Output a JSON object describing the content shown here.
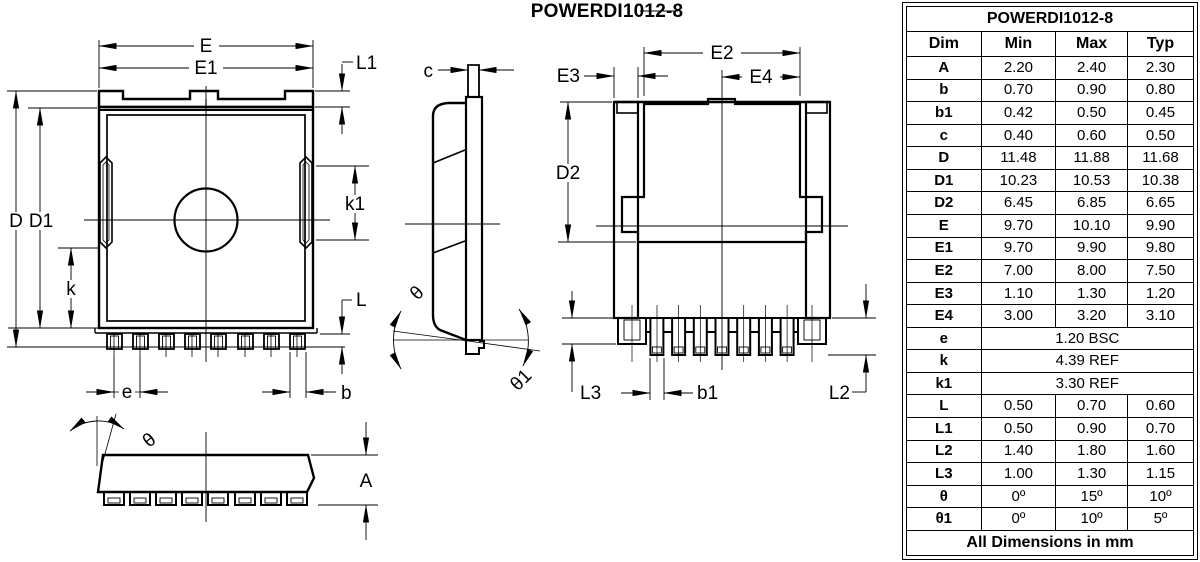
{
  "page_title": "POWERDI1012-8",
  "drawing_labels": {
    "top_view": {
      "E": "E",
      "E1": "E1",
      "L1": "L1",
      "D": "D",
      "D1": "D1",
      "k1": "k1",
      "k": "k",
      "L": "L",
      "e": "e",
      "b": "b"
    },
    "side_view": {
      "c": "c",
      "theta": "θ",
      "theta1": "θ1"
    },
    "bottom_view": {
      "E2": "E2",
      "E3": "E3",
      "E4": "E4",
      "D2": "D2",
      "b1": "b1",
      "L3": "L3",
      "L2": "L2"
    },
    "front_view": {
      "theta": "θ",
      "A": "A"
    }
  },
  "table": {
    "title": "POWERDI1012-8",
    "headers": [
      "Dim",
      "Min",
      "Max",
      "Typ"
    ],
    "rows": [
      {
        "dim": "A",
        "min": "2.20",
        "max": "2.40",
        "typ": "2.30"
      },
      {
        "dim": "b",
        "min": "0.70",
        "max": "0.90",
        "typ": "0.80"
      },
      {
        "dim": "b1",
        "min": "0.42",
        "max": "0.50",
        "typ": "0.45"
      },
      {
        "dim": "c",
        "min": "0.40",
        "max": "0.60",
        "typ": "0.50"
      },
      {
        "dim": "D",
        "min": "11.48",
        "max": "11.88",
        "typ": "11.68"
      },
      {
        "dim": "D1",
        "min": "10.23",
        "max": "10.53",
        "typ": "10.38"
      },
      {
        "dim": "D2",
        "min": "6.45",
        "max": "6.85",
        "typ": "6.65"
      },
      {
        "dim": "E",
        "min": "9.70",
        "max": "10.10",
        "typ": "9.90"
      },
      {
        "dim": "E1",
        "min": "9.70",
        "max": "9.90",
        "typ": "9.80"
      },
      {
        "dim": "E2",
        "min": "7.00",
        "max": "8.00",
        "typ": "7.50"
      },
      {
        "dim": "E3",
        "min": "1.10",
        "max": "1.30",
        "typ": "1.20"
      },
      {
        "dim": "E4",
        "min": "3.00",
        "max": "3.20",
        "typ": "3.10"
      },
      {
        "dim": "e",
        "span": "1.20 BSC"
      },
      {
        "dim": "k",
        "span": "4.39 REF"
      },
      {
        "dim": "k1",
        "span": "3.30 REF"
      },
      {
        "dim": "L",
        "min": "0.50",
        "max": "0.70",
        "typ": "0.60"
      },
      {
        "dim": "L1",
        "min": "0.50",
        "max": "0.90",
        "typ": "0.70"
      },
      {
        "dim": "L2",
        "min": "1.40",
        "max": "1.80",
        "typ": "1.60"
      },
      {
        "dim": "L3",
        "min": "1.00",
        "max": "1.30",
        "typ": "1.15"
      },
      {
        "dim": "θ",
        "min": "0º",
        "max": "15º",
        "typ": "10º"
      },
      {
        "dim": "θ1",
        "min": "0º",
        "max": "10º",
        "typ": "5º"
      }
    ],
    "footer": "All Dimensions in mm"
  }
}
